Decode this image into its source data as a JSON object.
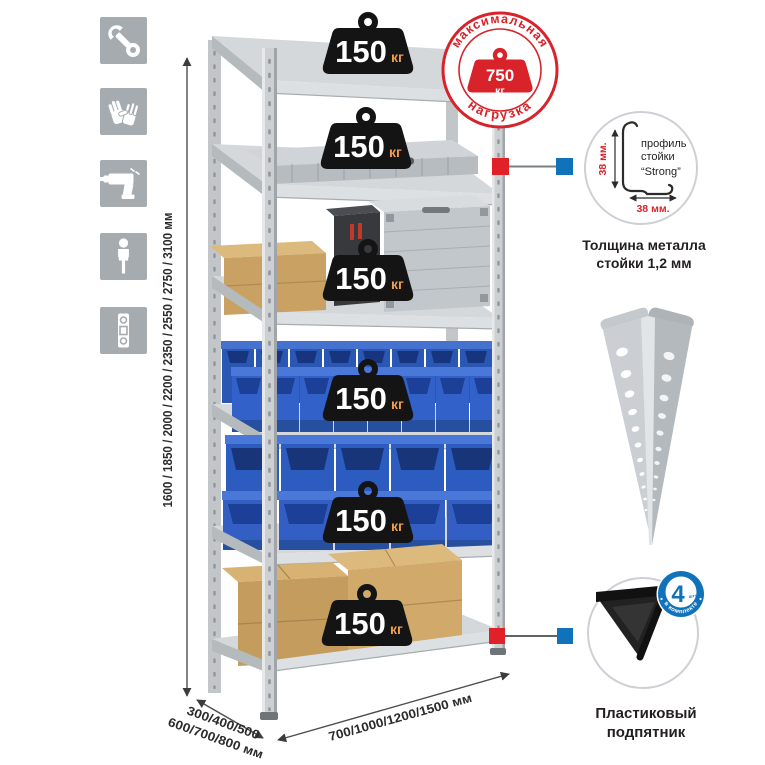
{
  "annotations": {
    "height_options": "1600 / 1850 / 2000 / 2200 / 2350 / 2550 / 2750 / 3100 мм",
    "depth_options_line1": "300/400/500",
    "depth_options_line2": "600/700/800 мм",
    "width_options": "700/1000/1200/1500 мм"
  },
  "shelf_badges": [
    {
      "value": "150",
      "unit": "кг"
    },
    {
      "value": "150",
      "unit": "кг"
    },
    {
      "value": "150",
      "unit": "кг"
    },
    {
      "value": "150",
      "unit": "кг"
    },
    {
      "value": "150",
      "unit": "кг"
    },
    {
      "value": "150",
      "unit": "кг"
    }
  ],
  "max_load_stamp": {
    "arc_top": "максимальная",
    "arc_bottom": "нагрузка",
    "value": "750",
    "unit": "кг"
  },
  "profile_detail": {
    "label_line1": "профиль",
    "label_line2": "стойки",
    "label_line3": "“Strong”",
    "vertical_dim": "38 мм.",
    "horizontal_dim": "38 мм.",
    "caption_line1": "Толщина металла",
    "caption_line2": "стойки 1,2 мм"
  },
  "foot_detail": {
    "badge_value": "4",
    "badge_small_text": "штуки",
    "badge_arc_text": "в комплекте",
    "caption_line1": "Пластиковый",
    "caption_line2": "подпятник"
  },
  "icons": [
    {
      "name": "wrench-icon"
    },
    {
      "name": "gloves-icon"
    },
    {
      "name": "drill-icon"
    },
    {
      "name": "person-icon"
    },
    {
      "name": "level-icon"
    }
  ],
  "colors": {
    "accent_red": "#d8232a",
    "marker_red": "#e02127",
    "marker_blue": "#1073ba",
    "icon_bg": "#a6abb0",
    "badge_black": "#141414",
    "kg_orange": "#f09d4e"
  }
}
